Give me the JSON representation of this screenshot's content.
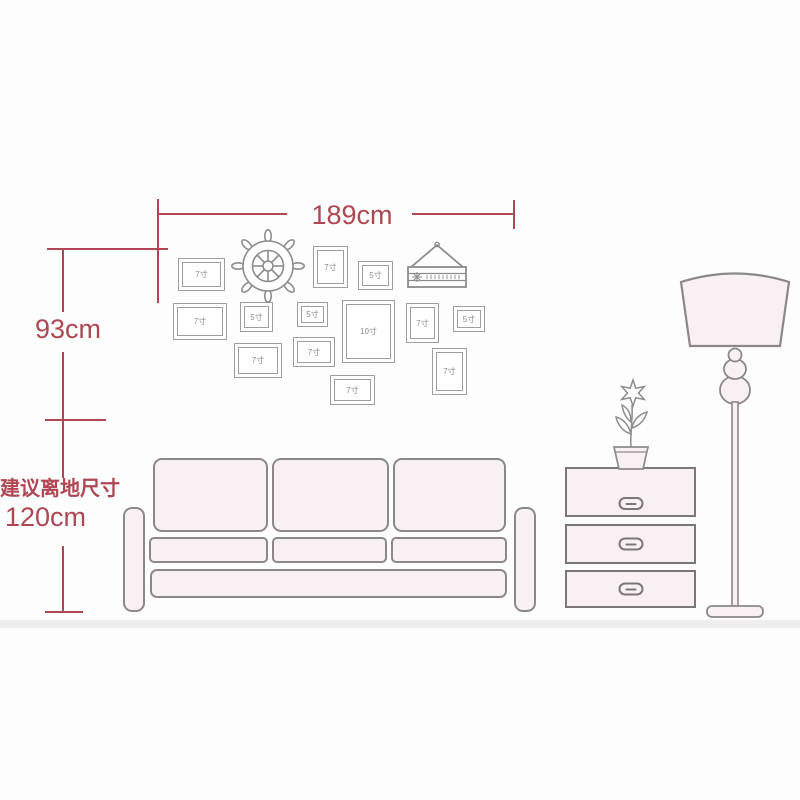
{
  "palette": {
    "dimension_red": "#ae4753",
    "outline_gray": "#8b888b",
    "frame_gray": "#a09da0",
    "frame_label_gray": "#8a8a8a",
    "fill_pink": "#f8f0f2",
    "floor_gray": "#f0edee",
    "background": "#fefdfd"
  },
  "annotations": {
    "width_label": "189cm",
    "height_label": "93cm",
    "floor_clearance_title": "建议离地尺寸",
    "floor_clearance_value": "120cm"
  },
  "photo_wall": {
    "frames": [
      {
        "label": "7寸",
        "x": 178,
        "y": 258,
        "w": 47,
        "h": 33
      },
      {
        "label": "7寸",
        "x": 313,
        "y": 246,
        "w": 35,
        "h": 42
      },
      {
        "label": "5寸",
        "x": 358,
        "y": 261,
        "w": 35,
        "h": 29
      },
      {
        "label": "7寸",
        "x": 173,
        "y": 303,
        "w": 54,
        "h": 37
      },
      {
        "label": "5寸",
        "x": 240,
        "y": 302,
        "w": 33,
        "h": 30
      },
      {
        "label": "5寸",
        "x": 297,
        "y": 302,
        "w": 31,
        "h": 25
      },
      {
        "label": "10寸",
        "x": 342,
        "y": 300,
        "w": 53,
        "h": 63
      },
      {
        "label": "7寸",
        "x": 406,
        "y": 303,
        "w": 33,
        "h": 40
      },
      {
        "label": "5寸",
        "x": 453,
        "y": 306,
        "w": 32,
        "h": 26
      },
      {
        "label": "7寸",
        "x": 234,
        "y": 343,
        "w": 48,
        "h": 35
      },
      {
        "label": "7寸",
        "x": 293,
        "y": 337,
        "w": 42,
        "h": 30
      },
      {
        "label": "7寸",
        "x": 432,
        "y": 348,
        "w": 35,
        "h": 47
      },
      {
        "label": "7寸",
        "x": 330,
        "y": 375,
        "w": 45,
        "h": 30
      }
    ],
    "decorations": [
      {
        "name": "ship-wheel-decor"
      },
      {
        "name": "hanging-board-decor"
      }
    ]
  },
  "furniture": {
    "sofa": "three-seat-sofa",
    "cabinet": "three-drawer-cabinet",
    "cabinet_drawers": 3,
    "lamp": "floor-lamp",
    "plant": "potted-flower"
  }
}
